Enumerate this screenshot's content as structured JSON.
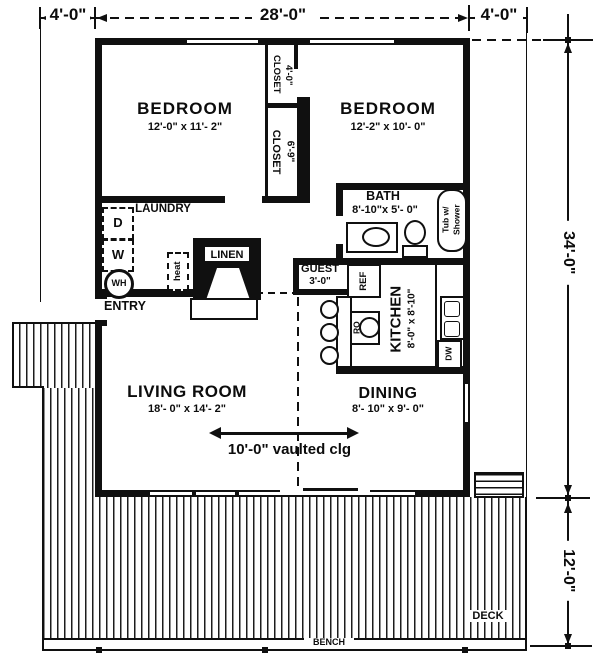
{
  "colors": {
    "ink": "#101010",
    "paper": "#ffffff"
  },
  "dimensions": {
    "top_left": "4'-0\"",
    "top_span": "28'-0\"",
    "top_right": "4'-0\"",
    "side_height": "34'-0\"",
    "deck_depth": "12'-0\""
  },
  "rooms": {
    "bedroom_left": {
      "label": "BEDROOM",
      "size": "12'-0\" x 11'- 2\""
    },
    "bedroom_right": {
      "label": "BEDROOM",
      "size": "12'-2\" x 10'- 0\""
    },
    "closet_top": {
      "label": "CLOSET",
      "size": "4'-0\""
    },
    "closet_lower": {
      "label": "CLOSET",
      "size": "6'-9\""
    },
    "bath": {
      "label": "BATH",
      "size": "8'-10\"x 5'- 0\""
    },
    "laundry": {
      "label": "LAUNDRY"
    },
    "entry": {
      "label": "ENTRY"
    },
    "guest_closet": {
      "label": "GUEST",
      "size": "3'-0\""
    },
    "kitchen": {
      "label": "KITCHEN",
      "size": "8'-0\" x 8'-10\""
    },
    "living_room": {
      "label": "LIVING ROOM",
      "size": "18'- 0\" x 14'- 2\""
    },
    "dining": {
      "label": "DINING",
      "size": "8'- 10\" x 9'- 0\""
    },
    "linen": {
      "label": "LINEN"
    },
    "deck": {
      "label": "DECK"
    },
    "bench": {
      "label": "BENCH"
    }
  },
  "fixtures": {
    "dryer": "D",
    "washer": "W",
    "water_heater": "WH",
    "heater": "heat",
    "tub_line1": "Tub w/",
    "tub_line2": "Shower",
    "refrigerator": "REF",
    "range_oven": "RO",
    "dishwasher": "DW"
  },
  "annotations": {
    "ceiling": "10'-0\" vaulted clg"
  }
}
